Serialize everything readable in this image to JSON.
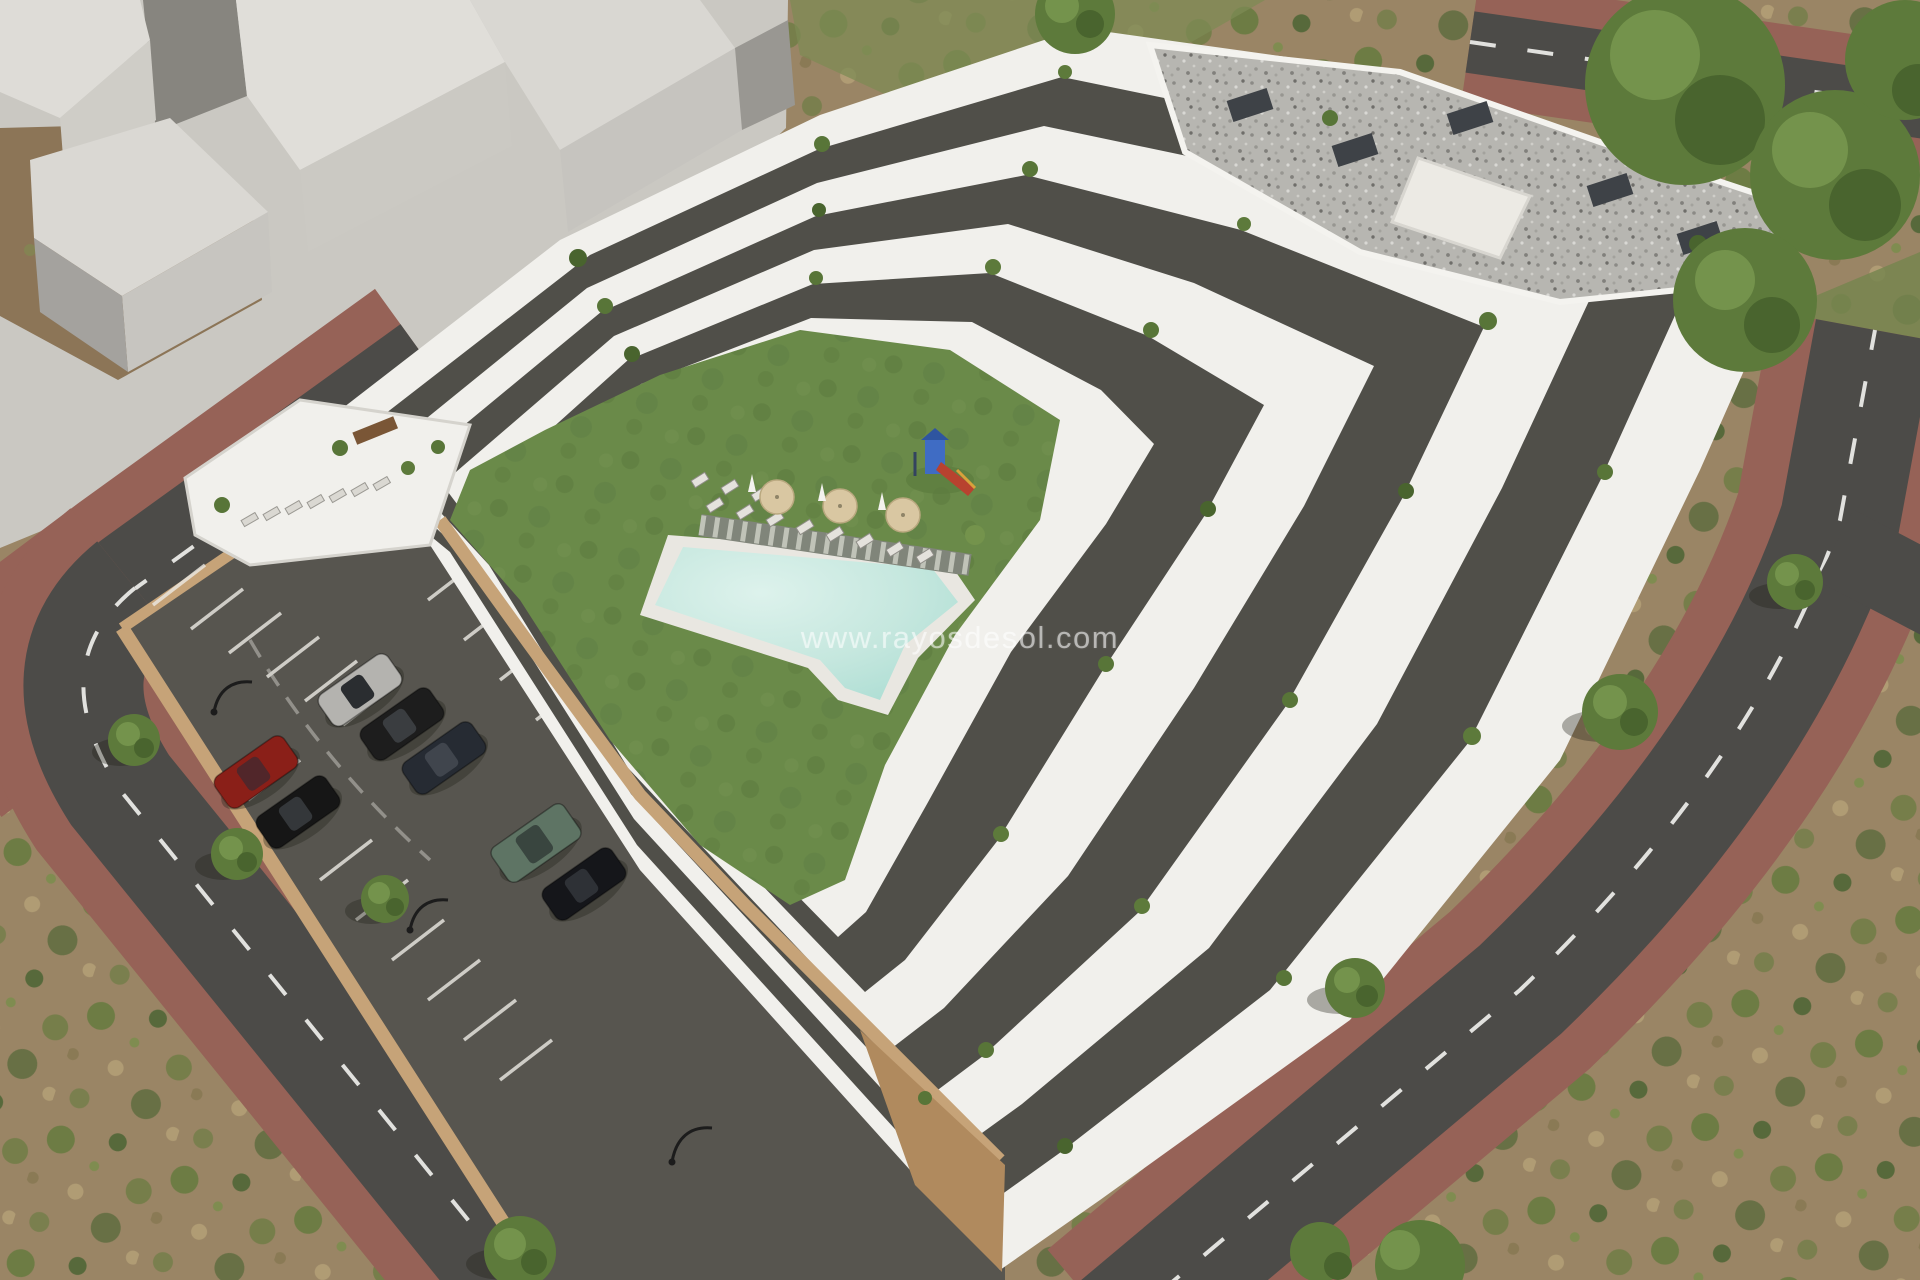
{
  "scene": {
    "type": "architectural-render-aerial",
    "watermark": "www.rayosdesol.com",
    "description": "Aerial 3D render of a terraced white apartment complex with communal lawn, swimming pool, sun loungers, parasols, playground, private parking lot with cars, perimeter roads with red paver sidewalks, scrubland and trees",
    "courtyard": {
      "parasol_count": 3,
      "pool_lounger_count": 11,
      "has_playground": true,
      "has_wooden_walkway": true
    },
    "parking": {
      "car_count": 7,
      "car_colors": [
        "#b4b3af",
        "#1d1d1d",
        "#262b33",
        "#8a1f18",
        "#161616",
        "#5e7464",
        "#15161a"
      ],
      "lamp_count": 3
    },
    "building": {
      "roof_type": "gravel-flat-roof",
      "terrace_bands": 7,
      "roof_vent_count": 5
    },
    "context_building_count": 4
  },
  "palette": {
    "plaza": "#cac8c2",
    "building_white": "#f1f0ec",
    "building_shade": "#c9c7c1",
    "recess_dark": "#504f49",
    "lawn": "#6a8a49",
    "lawn_dark": "#5d7c3f",
    "pool": "#c5e7de",
    "pool_light": "#ddf2ec",
    "pool_deck": "#e9e7e1",
    "asphalt": "#4c4b48",
    "parking_asphalt": "#57554f",
    "brick_base": "#966257",
    "brick_dark": "#7d4f47",
    "tan_wall": "#c6a378",
    "tan_wall_side": "#b08a5e",
    "scrub_base": "#9a8565",
    "scrub_green": "#6d7c44",
    "scrub_dark": "#57693b",
    "scrub_light": "#b09c74",
    "gravel_base": "#b7b6b1",
    "gravel_dark": "#8b8a86",
    "dirt": "#8c7557",
    "tree_green": "#5d7a3b",
    "tree_dark": "#49642e",
    "tree_light": "#74934c",
    "plant_green": "#587538",
    "walkway": "#80857a",
    "walkway_slat": "#cfd2c8",
    "parasol_tan": "#d9c7a2",
    "playground_blue": "#3f6cc4",
    "playground_red": "#b8422f",
    "table_wood": "#7a5636"
  }
}
